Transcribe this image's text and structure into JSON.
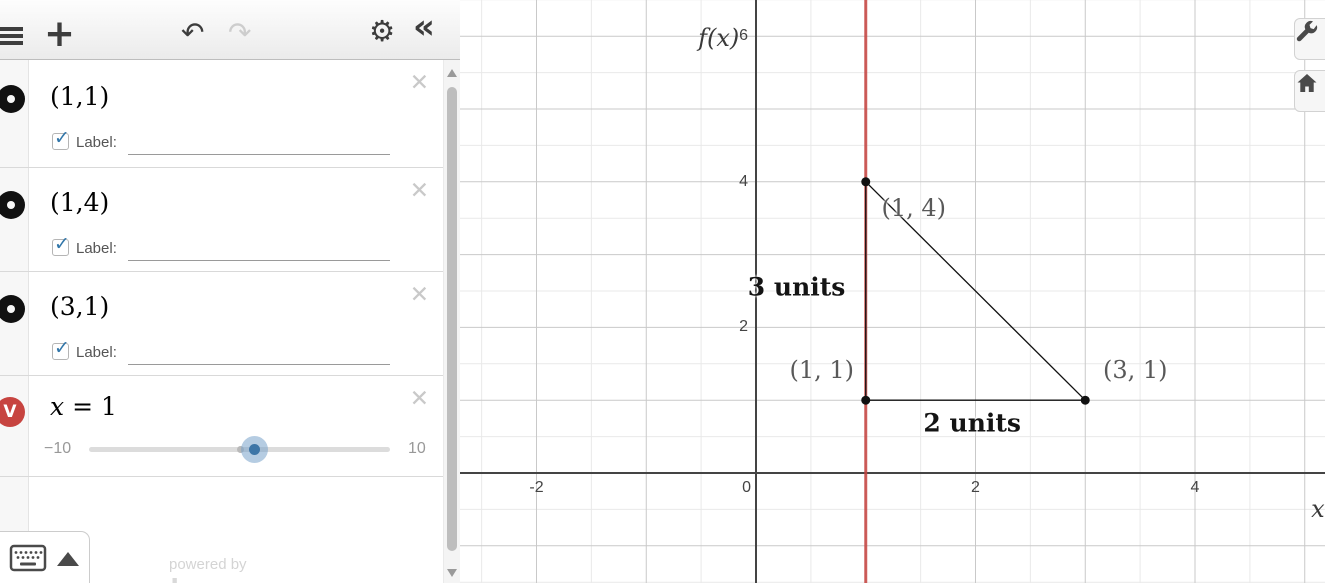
{
  "toolbar": {
    "add_glyph": "+",
    "undo_glyph": "↶",
    "redo_glyph": "↷",
    "gear_glyph": "⚙",
    "collapse_glyph": "«"
  },
  "expressions": [
    {
      "latex": "(1,1)",
      "label_text": "Label:",
      "label_value": ""
    },
    {
      "latex": "(1,4)",
      "label_text": "Label:",
      "label_value": ""
    },
    {
      "latex": "(3,1)",
      "label_text": "Label:",
      "label_value": ""
    },
    {
      "var": "x",
      "eq": "= 1",
      "slider": {
        "min": -10,
        "max": 10,
        "value": 1,
        "min_label": "−10",
        "max_label": "10"
      }
    }
  ],
  "footer": {
    "powered_by": "powered by",
    "brand": "desmos"
  },
  "chart_data": {
    "type": "scatter",
    "points": [
      {
        "x": 1,
        "y": 1,
        "label": "(1, 1)",
        "label_offset": [
          -44,
          -30
        ]
      },
      {
        "x": 1,
        "y": 4,
        "label": "(1, 4)",
        "label_offset": [
          48,
          26
        ]
      },
      {
        "x": 3,
        "y": 1,
        "label": "(3, 1)",
        "label_offset": [
          50,
          -30
        ]
      }
    ],
    "segments": [
      [
        [
          1,
          1
        ],
        [
          1,
          4
        ]
      ],
      [
        [
          1,
          4
        ],
        [
          3,
          1
        ]
      ],
      [
        [
          1,
          1
        ],
        [
          3,
          1
        ]
      ]
    ],
    "vertical_line": {
      "x": 1,
      "color": "#c74440"
    },
    "annotations": [
      {
        "text": "3 units",
        "x": 0.37,
        "y": 2.56
      },
      {
        "text": "2 units",
        "x": 1.97,
        "y": 0.68
      }
    ],
    "x_ticks": [
      {
        "v": -2,
        "label": "-2"
      },
      {
        "v": 0,
        "label": "0"
      },
      {
        "v": 2,
        "label": "2"
      },
      {
        "v": 4,
        "label": "4"
      }
    ],
    "y_ticks": [
      {
        "v": 2,
        "label": "2"
      },
      {
        "v": 4,
        "label": "4"
      },
      {
        "v": 6,
        "label": "6"
      }
    ],
    "axis_labels": [
      {
        "text": "f(x)",
        "x": -0.34,
        "y": 5.98
      },
      {
        "text": "x",
        "x": 5.12,
        "y": -0.49
      }
    ],
    "view": {
      "xmin": -2.7,
      "xmax": 5.19,
      "ymin": -1.51,
      "ymax": 6.5
    },
    "grid": {
      "minor_step": 0.5,
      "major_step": 1,
      "minor_color": "#e9e9e9",
      "major_color": "#c9c9c9",
      "axis_color": "#444444"
    },
    "point_color": "#111111",
    "segment_color": "#111111",
    "layout": {
      "ox": 296,
      "oy": 473,
      "sx": 109.75,
      "sy": 72.8,
      "w": 865,
      "h": 583
    }
  }
}
